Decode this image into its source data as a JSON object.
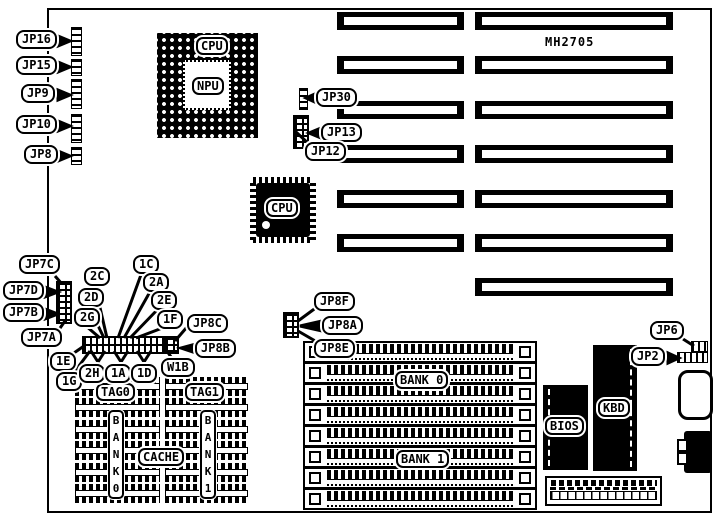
{
  "title": {
    "model": "MH2705"
  },
  "sockets": {
    "cpu_pga": "CPU",
    "npu": "NPU",
    "cpu_qfp": "CPU",
    "bios": "BIOS",
    "kbd": "KBD"
  },
  "memory": {
    "simm_bank0": "BANK 0",
    "simm_bank1": "BANK 1",
    "tag0": "TAG0",
    "tag1": "TAG1",
    "cache_bank0_vertical": "B\nA\nN\nK\n0",
    "cache_bank1_vertical": "B\nA\nN\nK\n1",
    "cache": "CACHE"
  },
  "jumper_labels": {
    "jp16": "JP16",
    "jp15": "JP15",
    "jp9": "JP9",
    "jp10": "JP10",
    "jp8": "JP8",
    "jp7c": "JP7C",
    "jp7d": "JP7D",
    "jp7b": "JP7B",
    "jp7a": "JP7A",
    "jp30": "JP30",
    "jp13": "JP13",
    "jp12": "JP12",
    "jp8f": "JP8F",
    "jp8a": "JP8A",
    "jp8e": "JP8E",
    "jp8c": "JP8C",
    "jp8b": "JP8B",
    "jp6": "JP6",
    "jp2": "JP2"
  },
  "cache_jumper_labels": {
    "l2c": "2C",
    "l2d": "2D",
    "l2g": "2G",
    "l1c": "1C",
    "l2a": "2A",
    "l2e": "2E",
    "l1f": "1F",
    "l1e": "1E",
    "l1g": "1G",
    "l2h": "2H",
    "l1a": "1A",
    "l1d": "1D",
    "w1b": "W1B"
  },
  "colors": {
    "ink": "#000000",
    "paper": "#ffffff"
  }
}
